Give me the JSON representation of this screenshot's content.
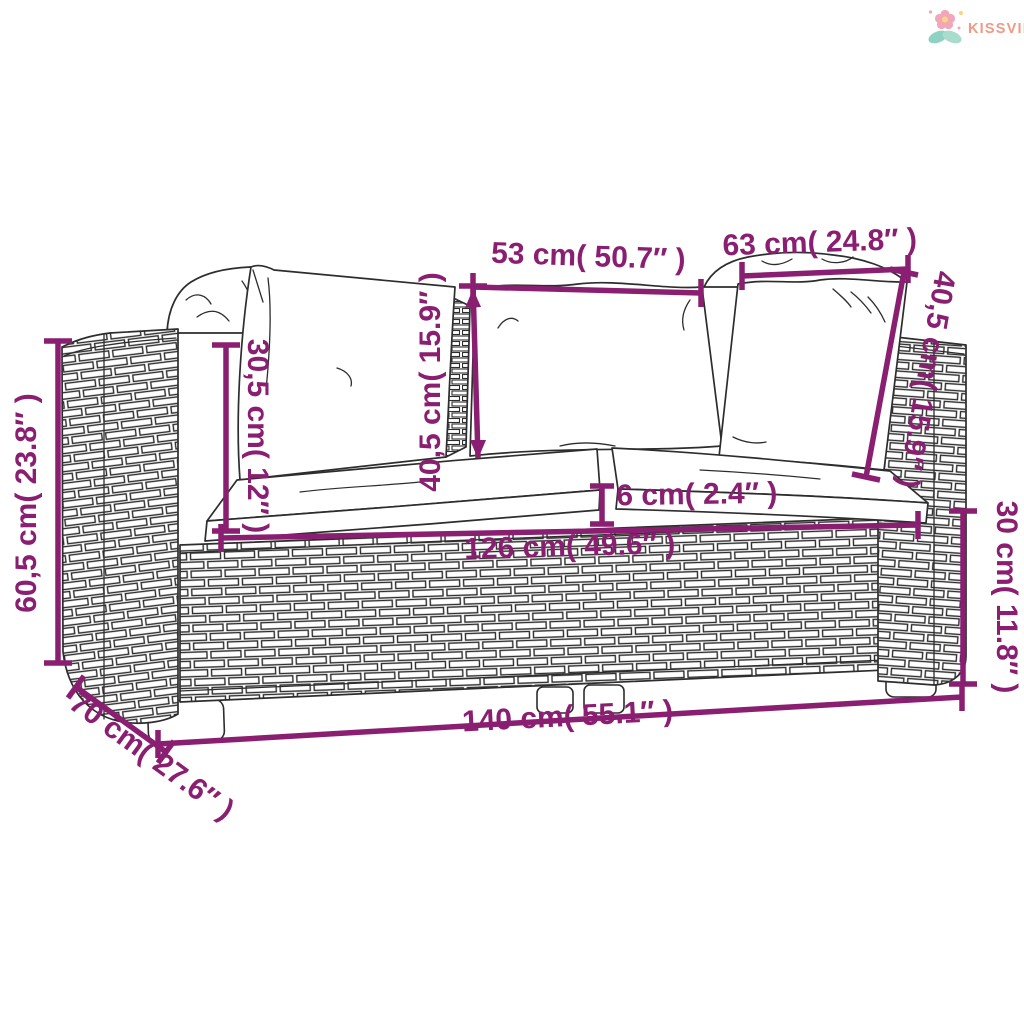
{
  "page": {
    "background": "#ffffff",
    "type": "product dimension diagram"
  },
  "logo": {
    "brand": "KISSVILÁG",
    "text_color": "#f09a86",
    "icon": "flower-sprout-icon",
    "icon_colors": {
      "petals": "#f2a7b9",
      "leaves": "#8ed2c3",
      "accents": "#f6d77f"
    }
  },
  "colors": {
    "dimension": "#8a1f72",
    "line_art": "#2d2d2d",
    "background": "#ffffff"
  },
  "product": {
    "description": "2-seat poly rattan garden sofa with white cushions and back pillows"
  },
  "dimensions": {
    "back_top_left": "53 cm( 50.7″ )",
    "back_top_right": "63 cm( 24.8″ )",
    "pillow_height_middle": "40,5 cm( 15.9″ )",
    "pillow_height_right": "40,5 cm( 15.9″ )",
    "armrest_height_above_seat": "30,5 cm( 12″ )",
    "total_height": "60,5 cm( 23.8″ )",
    "cushion_thickness": "6 cm( 2.4″ )",
    "seat_width_inner": "126 cm( 49.6″ )",
    "base_height": "30 cm( 11.8″ )",
    "total_width": "140 cm( 55.1″ )",
    "total_depth": "70 cm( 27.6″ )"
  }
}
